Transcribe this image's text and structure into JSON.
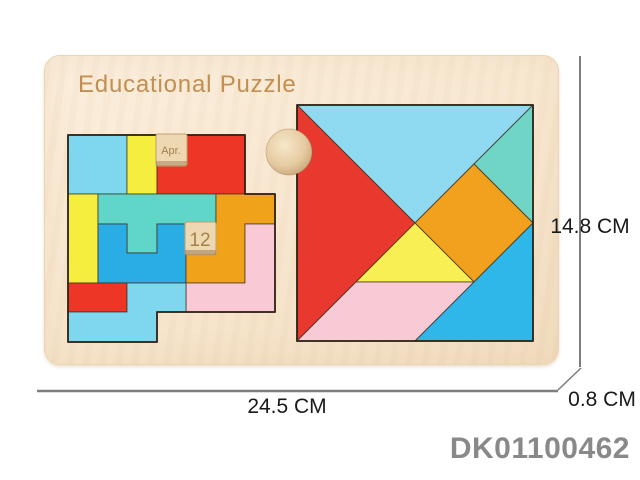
{
  "title": "Educational Puzzle",
  "product_code": "DK01100462",
  "dimensions": {
    "width": "24.5 CM",
    "height": "14.8 CM",
    "thickness": "0.8 CM"
  },
  "block_puzzle": {
    "month_tile": "Apr.",
    "date_tile": "12",
    "tile_color": "#eed8b1",
    "tile_text_color": "#a5814a",
    "pieces": [
      {
        "name": "cyan-square",
        "color": "#7ed7ee"
      },
      {
        "name": "yellow-bar-top",
        "color": "#f6ee3f"
      },
      {
        "name": "red-l-piece",
        "color": "#ee3627"
      },
      {
        "name": "yellow-bar-left",
        "color": "#f6ee3f"
      },
      {
        "name": "turquoise-t-piece",
        "color": "#5fd6c8"
      },
      {
        "name": "blue-u-piece",
        "color": "#2aace4"
      },
      {
        "name": "orange-z-piece",
        "color": "#f0a21b"
      },
      {
        "name": "pink-l-piece",
        "color": "#f9cad5"
      },
      {
        "name": "red-bar-bottom",
        "color": "#ee3627"
      },
      {
        "name": "cyan-l-bottom",
        "color": "#7ed7ee"
      }
    ]
  },
  "tangram": {
    "pieces": [
      {
        "name": "large-triangle-top",
        "color": "#8fdaf1"
      },
      {
        "name": "large-triangle-left",
        "color": "#e9382e"
      },
      {
        "name": "small-triangle-right",
        "color": "#70d5c6"
      },
      {
        "name": "square-piece",
        "color": "#f1a11d"
      },
      {
        "name": "small-triangle-center",
        "color": "#f8ef55"
      },
      {
        "name": "parallelogram-piece",
        "color": "#f8cad6"
      },
      {
        "name": "medium-triangle-bottom",
        "color": "#2fb7ea"
      }
    ]
  },
  "board": {
    "color": "#f8e8d2",
    "title_color": "#c28f51",
    "dimension_line_color": "#7d7d7d"
  }
}
